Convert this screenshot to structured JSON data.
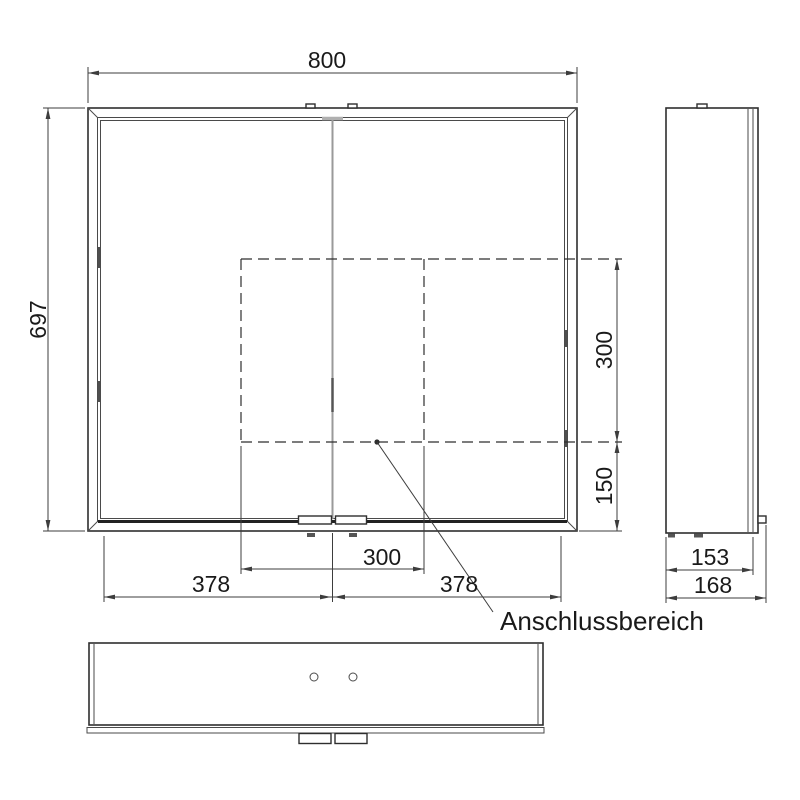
{
  "front": {
    "width": "800",
    "height": "697",
    "door_left_width": "378",
    "door_right_width": "378",
    "connection_width": "300",
    "connection_height": "300",
    "connection_bottom_offset": "150"
  },
  "side": {
    "depth_body": "153",
    "depth_total": "168"
  },
  "labels": {
    "connection_area": "Anschlussbereich"
  },
  "colors": {
    "object_line": "#2e2e2e",
    "dimension_line": "#3d3d3d",
    "door_split_line": "#9a9a9a",
    "background": "#ffffff"
  }
}
